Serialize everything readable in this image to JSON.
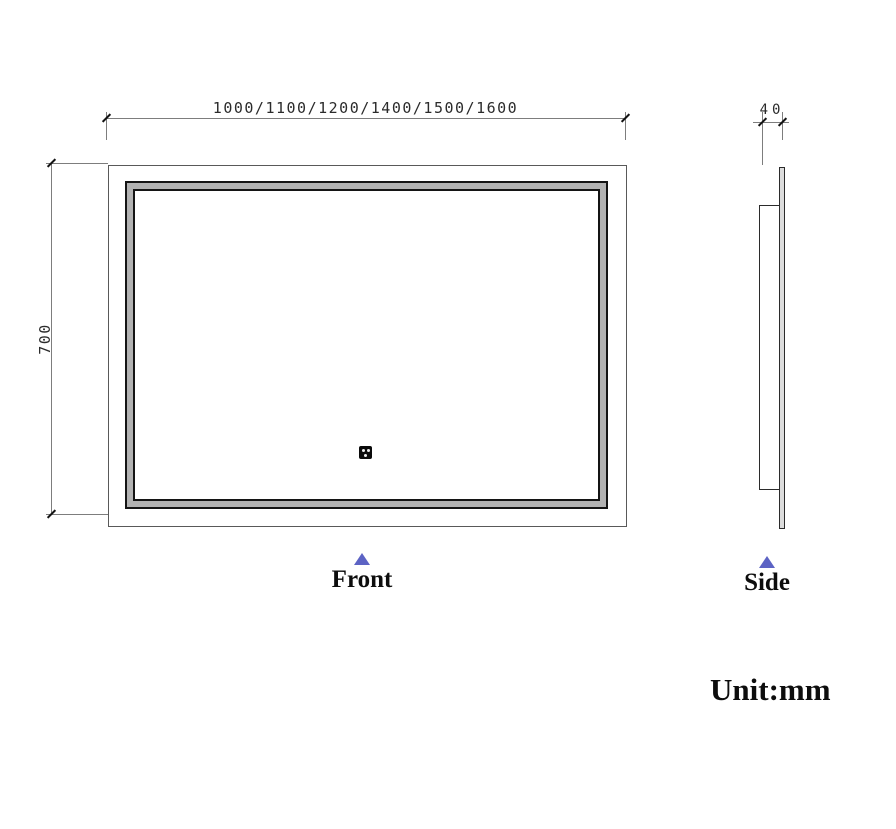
{
  "dimensions": {
    "front_width": "1000/1100/1200/1400/1500/1600",
    "front_height": "700",
    "side_thickness": "40"
  },
  "labels": {
    "front_view": "Front",
    "side_view": "Side",
    "unit_note": "Unit:mm"
  },
  "icons": {
    "sensor": "touch-sensor-icon",
    "front_pointer": "triangle-up-icon",
    "side_pointer": "triangle-up-icon"
  },
  "colors": {
    "frame_fill": "#b2b2b2",
    "frame_outline": "#141414",
    "outer_outline": "#595959",
    "side_outline": "#2b2b2b",
    "dimension_line": "#7d7d7d",
    "tick": "#141414",
    "pointer_triangle": "#5c63c4",
    "dimension_text": "#2b2b2b",
    "label_text": "#0d0d0d"
  }
}
